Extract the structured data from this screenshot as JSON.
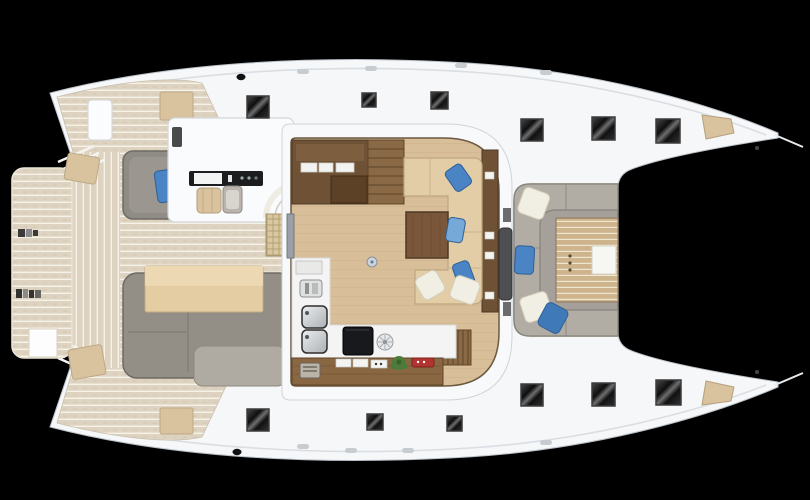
{
  "scene": {
    "description": "Catamaran yacht deck plan, top-down view",
    "background": "#000000"
  },
  "colors": {
    "hull": "#f5f7f9",
    "hull_outline": "#b9c0c7",
    "deck_seam": "#d9dee2",
    "deck_teak": "#ddd3c0",
    "teak_seam": "#f6f2e8",
    "interior_floor": "#d8bf99",
    "wood_dark": "#6f5236",
    "wood_medium": "#8a6743",
    "table_wood": "#7a573a",
    "stairs_wood": "#8a6a46",
    "upholstery_tan": "#e3cda6",
    "cushion_tan": "#d9c29e",
    "table_tan": "#e4cda3",
    "sofa_gray": "#938e86",
    "sofa_gray_light": "#b2ada4",
    "cockpit_floor_gray": "#a5a099",
    "pad_gray": "#8f8b85",
    "pillow_blue": "#4a84c4",
    "pillow_white": "#f1eee3",
    "hatch_frame": "#3c3c3c",
    "trampoline": "#000000",
    "counter_white": "#f3f4f3",
    "cooktop_black": "#17191c",
    "door_gray": "#4d4f52",
    "dashboard_black": "#1c1d1f",
    "plant_green": "#4e7a3a",
    "accent_red": "#b23430",
    "steel": "#c7ccd0"
  },
  "regions": {
    "swim_platform": "teak swim platform",
    "aft_deck": "aft cockpit deck",
    "helm_station": "helm console",
    "salon": "salon and galley",
    "forward_cockpit": "forward cockpit lounge",
    "trampoline": "bow trampoline",
    "hatches": "deck hatches"
  }
}
